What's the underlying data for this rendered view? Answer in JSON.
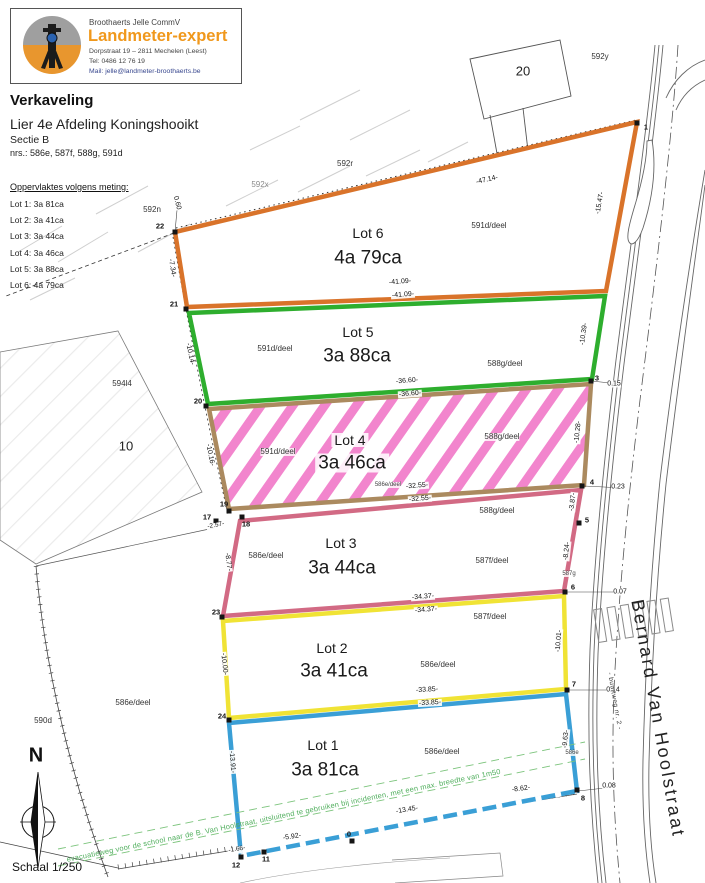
{
  "header": {
    "company": "Broothaerts Jelle CommV",
    "brand": "Landmeter-expert",
    "address": "Dorpstraat 19 – 2811 Mechelen (Leest)",
    "phone": "Tel: 0486 12 76 19",
    "email": "Mail: jelle@landmeter-broothaerts.be"
  },
  "title": {
    "main": "Verkaveling",
    "line1": "Lier 4e Afdeling Koningshooikt",
    "line2": "Sectie B",
    "line3": "nrs.: 586e, 587f, 588g, 591d"
  },
  "legend": {
    "heading": "Oppervlaktes volgens meting:",
    "items": [
      {
        "t": "Lot 1: 3a 81ca"
      },
      {
        "t": "Lot 2: 3a 41ca"
      },
      {
        "t": "Lot 3: 3a 44ca"
      },
      {
        "t": "Lot 4: 3a 46ca"
      },
      {
        "t": "Lot 5: 3a 88ca"
      },
      {
        "t": "Lot 6: 4a 79ca"
      }
    ]
  },
  "lots": [
    {
      "name": "Lot 6",
      "area": "4a 79ca",
      "border": "#d9732a"
    },
    {
      "name": "Lot 5",
      "area": "3a 88ca",
      "border": "#2eae2e"
    },
    {
      "name": "Lot 4",
      "area": "3a 46ca",
      "border": "#ab8a5f"
    },
    {
      "name": "Lot 3",
      "area": "3a 44ca",
      "border": "#d26a84"
    },
    {
      "name": "Lot 2",
      "area": "3a 41ca",
      "border": "#f0e335"
    },
    {
      "name": "Lot 1",
      "area": "3a 81ca",
      "border": "#3a9fd6"
    }
  ],
  "street": {
    "name": "Bernard Van Hoolstraat",
    "byway": "- buurtweg nr. 2 -"
  },
  "north": {
    "label": "N",
    "scale": "Schaal 1/250"
  },
  "notes": {
    "evacuation": "evacuatieweg voor de school naar de B. Van Hoolstraat, uitsluitend te gebruiken bij incidenten, met een max. breedte van 1m50"
  },
  "parcels": [
    {
      "t": "592y"
    },
    {
      "t": "20"
    },
    {
      "t": "592r"
    },
    {
      "t": "592x"
    },
    {
      "t": "592n"
    },
    {
      "t": "591d/deel"
    },
    {
      "t": "591d/deel"
    },
    {
      "t": "588g/deel"
    },
    {
      "t": "591d/deel"
    },
    {
      "t": "588g/deel"
    },
    {
      "t": "586e/deel"
    },
    {
      "t": "586e/deel"
    },
    {
      "t": "588g/deel"
    },
    {
      "t": "587f/deel"
    },
    {
      "t": "587f/deel"
    },
    {
      "t": "586e/deel"
    },
    {
      "t": "586e/deel"
    },
    {
      "t": "594l4"
    },
    {
      "t": "10"
    },
    {
      "t": "590d"
    },
    {
      "t": "586e/deel"
    },
    {
      "t": "587g"
    },
    {
      "t": "586e"
    }
  ],
  "dims": [
    {
      "t": "-47.14-"
    },
    {
      "t": "-15.47-"
    },
    {
      "t": "-7.34-"
    },
    {
      "t": "-41.09-"
    },
    {
      "t": "-41.09-"
    },
    {
      "t": "-10.39-"
    },
    {
      "t": "-10.14-"
    },
    {
      "t": "-36.60-"
    },
    {
      "t": "-36.60-"
    },
    {
      "t": "-10.28-"
    },
    {
      "t": "-10.16-"
    },
    {
      "t": "-32.55-"
    },
    {
      "t": "-32.55-"
    },
    {
      "t": "-2.57-"
    },
    {
      "t": "-3.87-"
    },
    {
      "t": "-8.77-"
    },
    {
      "t": "-8.24-"
    },
    {
      "t": "-34.37-"
    },
    {
      "t": "-34.37-"
    },
    {
      "t": "-10.01-"
    },
    {
      "t": "-10.00-"
    },
    {
      "t": "-33.85-"
    },
    {
      "t": "-33.85-"
    },
    {
      "t": "-9.63-"
    },
    {
      "t": "-13.91-"
    },
    {
      "t": "-1.66-"
    },
    {
      "t": "-5.92-"
    },
    {
      "t": "-13.45-"
    },
    {
      "t": "-8.62-"
    }
  ],
  "points": [
    {
      "t": "1"
    },
    {
      "t": "3"
    },
    {
      "t": "4"
    },
    {
      "t": "5"
    },
    {
      "t": "6"
    },
    {
      "t": "7"
    },
    {
      "t": "8"
    },
    {
      "t": "0"
    },
    {
      "t": "11"
    },
    {
      "t": "12"
    },
    {
      "t": "17"
    },
    {
      "t": "18"
    },
    {
      "t": "19"
    },
    {
      "t": "20"
    },
    {
      "t": "21"
    },
    {
      "t": "22"
    },
    {
      "t": "23"
    },
    {
      "t": "24"
    }
  ],
  "offsets": [
    {
      "t": "0.60"
    },
    {
      "t": "0.15"
    },
    {
      "t": "0.23"
    },
    {
      "t": "0.07"
    },
    {
      "t": "0.14"
    },
    {
      "t": "0.08"
    }
  ],
  "colors": {
    "lot6_orange": "#d9732a",
    "lot5_green": "#2eae2e",
    "lot4_tan": "#ab8a5f",
    "lot4_hatch_pink": "#f285cd",
    "lot3_rose": "#d26a84",
    "lot2_yellow": "#f0e335",
    "lot1_blue": "#3a9fd6",
    "brand_orange": "#f0981c",
    "evac_green": "#4fae5c"
  }
}
